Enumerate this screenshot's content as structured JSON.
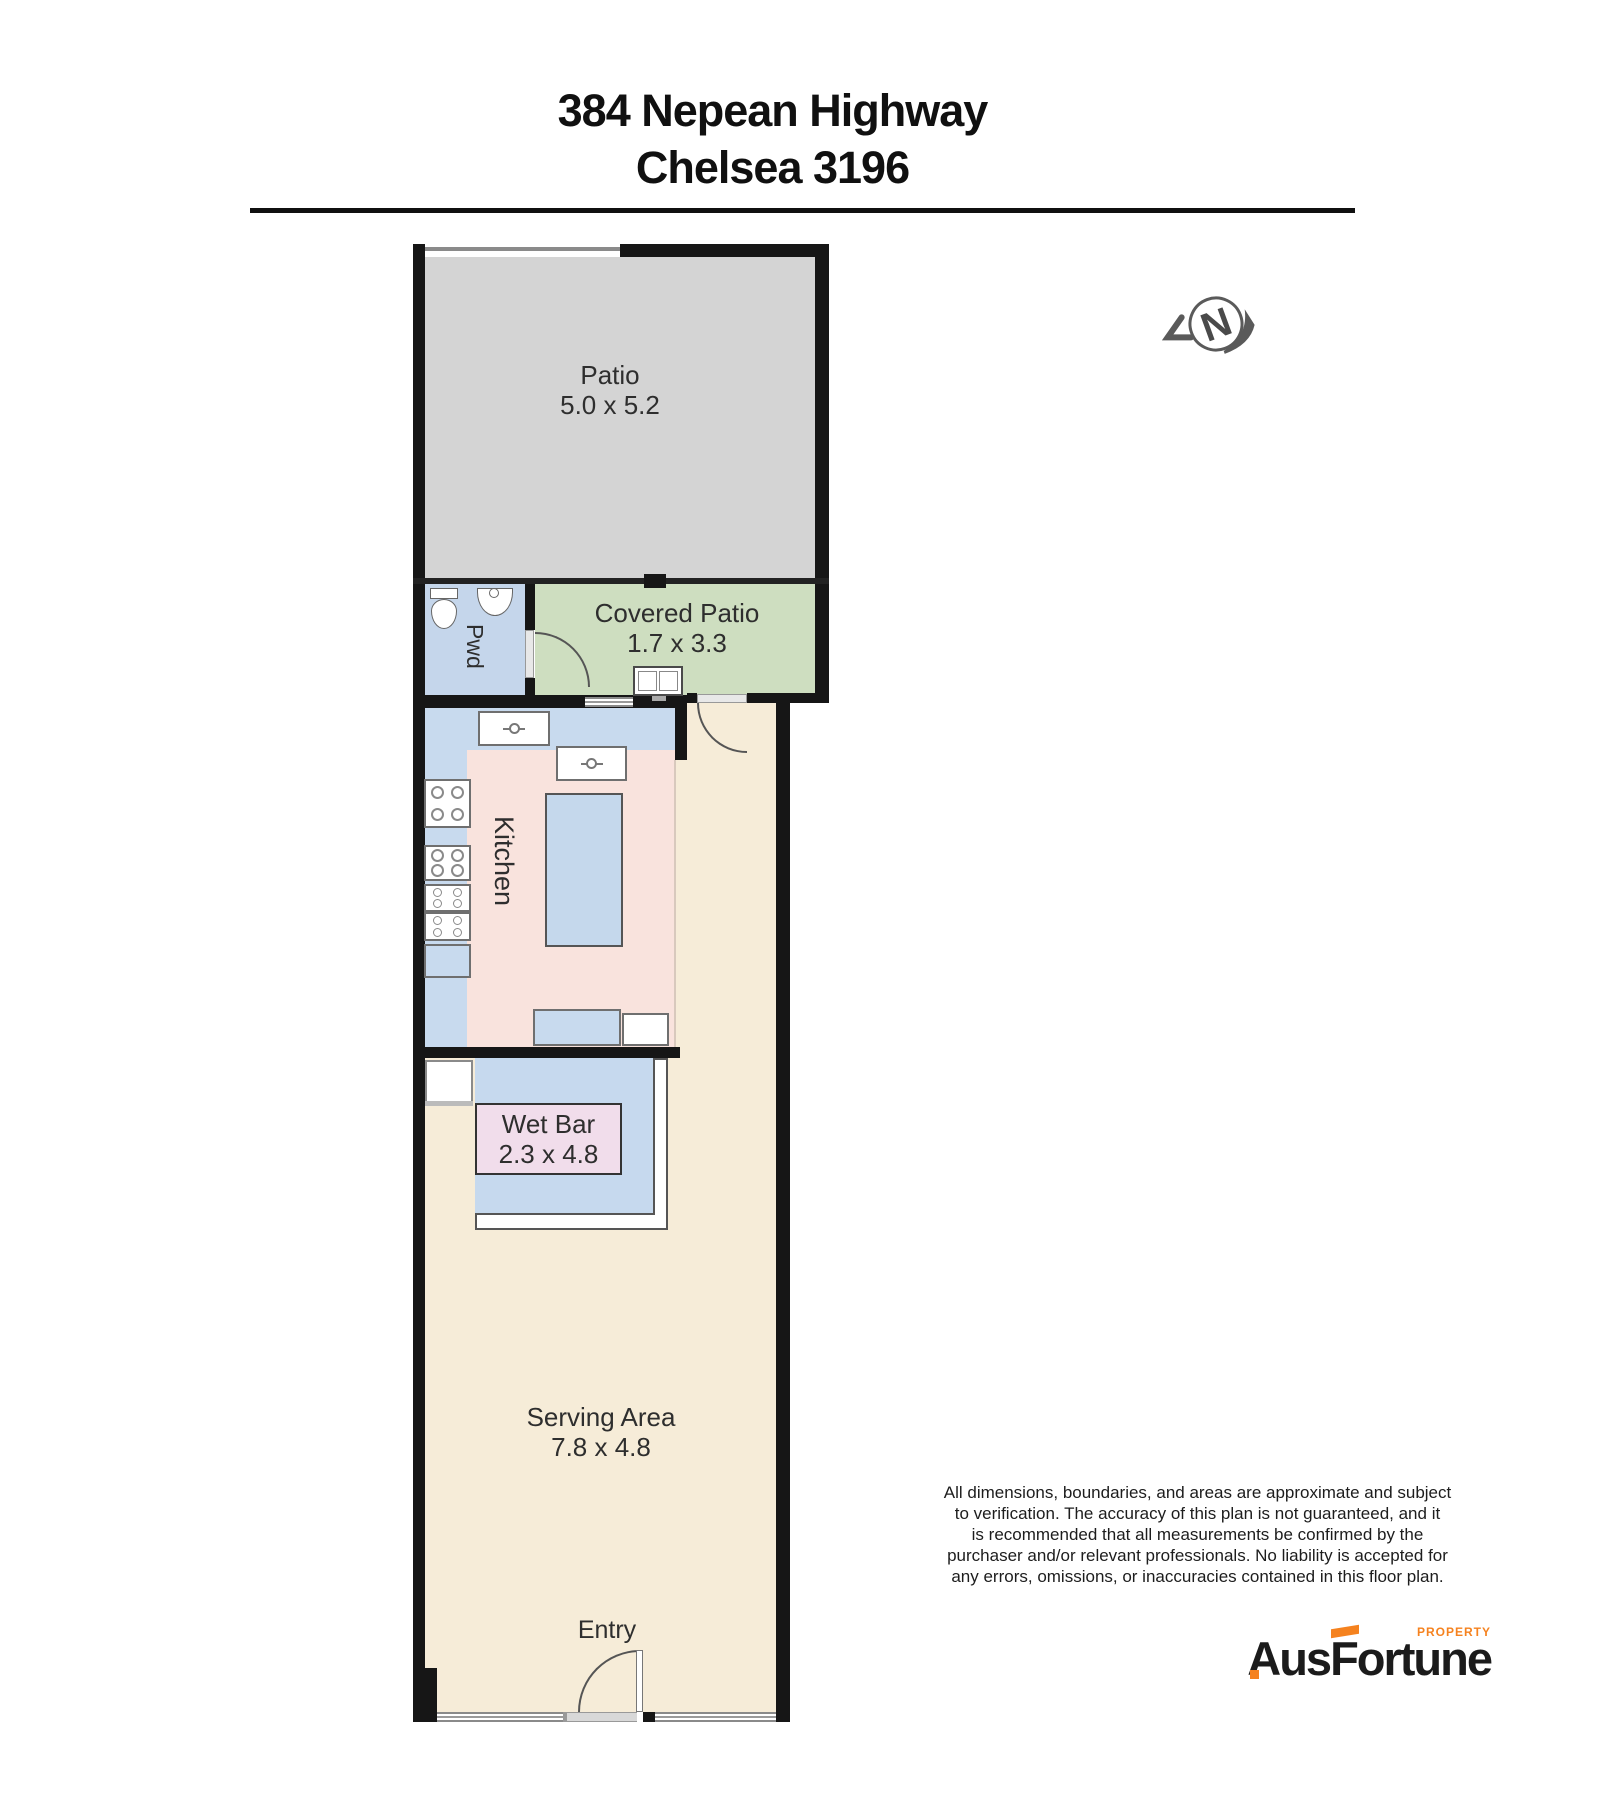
{
  "header": {
    "title_line1": "384 Nepean Highway",
    "title_line2": "Chelsea 3196"
  },
  "compass": {
    "label": "N"
  },
  "rooms": {
    "patio": {
      "label": "Patio",
      "dims": "5.0 x 5.2"
    },
    "pwd": {
      "label": "Pwd"
    },
    "covered_patio": {
      "label": "Covered Patio",
      "dims": "1.7 x 3.3"
    },
    "kitchen": {
      "label": "Kitchen"
    },
    "wet_bar": {
      "label": "Wet Bar",
      "dims": "2.3 x 4.8"
    },
    "serving_area": {
      "label": "Serving Area",
      "dims": "7.8 x 4.8"
    },
    "entry": {
      "label": "Entry"
    }
  },
  "disclaimer": {
    "lines": [
      "All dimensions, boundaries, and areas are approximate and subject",
      "to verification. The accuracy of this plan is not guaranteed, and it",
      "is recommended that all measurements be confirmed by the",
      "purchaser and/or relevant professionals. No liability is accepted for",
      "any errors, omissions, or inaccuracies contained in this floor plan."
    ]
  },
  "logo": {
    "brand_prefix": "Aus",
    "brand_f": "F",
    "brand_suffix": "ortune",
    "tagline": "PROPERTY"
  },
  "colors": {
    "wall_black": "#161616",
    "patio_grey": "#d4d4d4",
    "pwd_blue": "#c5d6eb",
    "covered_patio_green": "#cedec0",
    "kitchen_pink": "#f9e3dd",
    "counter_blue": "#c8daee",
    "serving_beige": "#f6ecd8",
    "wetbar_label_pink": "#f1ddeb",
    "brand_orange": "#f5821f"
  }
}
